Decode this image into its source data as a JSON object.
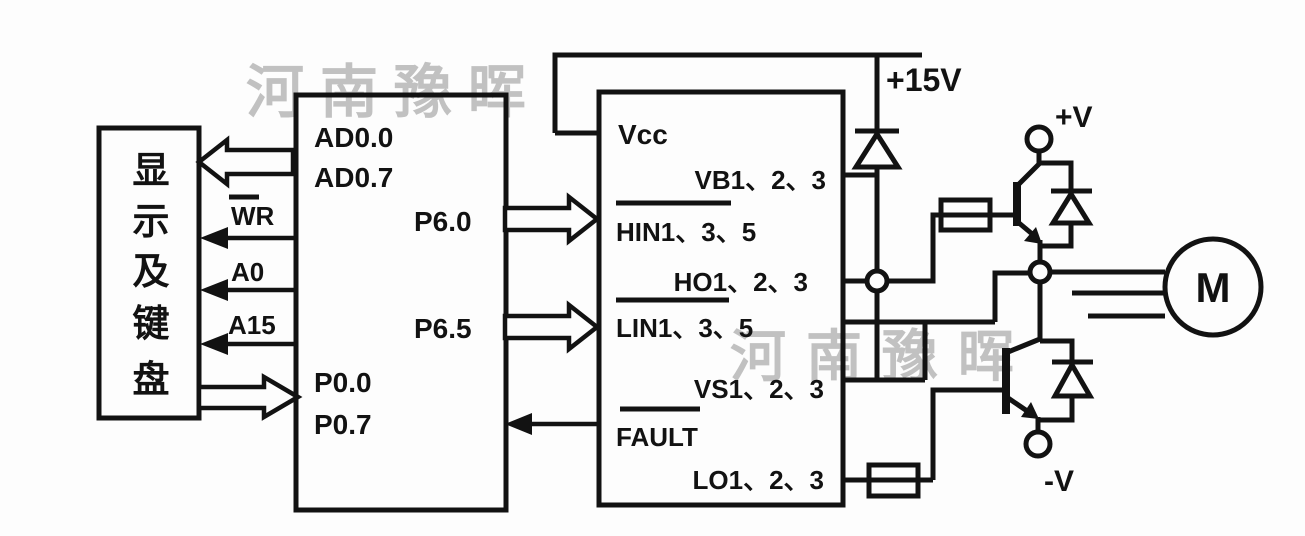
{
  "figure_type": "motor-drive circuit schematic (MCU + gate driver + IGBT half-bridge + motor)",
  "colors": {
    "ink": "#121212",
    "background": "#fdfdfd",
    "watermark": "#9e9e9e"
  },
  "watermark": {
    "text": "河南豫晖"
  },
  "left_box": {
    "chars": [
      "显",
      "示",
      "及",
      "键",
      "盘"
    ]
  },
  "mcu": {
    "ad00": "AD0.0",
    "ad07": "AD0.7",
    "p60": "P6.0",
    "p65": "P6.5",
    "p00": "P0.0",
    "p07": "P0.7"
  },
  "bus_labels": {
    "wr": "WR",
    "a0": "A0",
    "a15": "A15"
  },
  "driver": {
    "vcc": "Vcc",
    "vb": "VB1、2、3",
    "hin": "HIN1、3、5",
    "ho": "HO1、2、3",
    "lin": "LIN1、3、5",
    "vs": "VS1、2、3",
    "fault": "FAULT",
    "lo": "LO1、2、3"
  },
  "power": {
    "rail": "+15V",
    "pos": "+V",
    "neg": "-V"
  },
  "motor": {
    "label": "M"
  }
}
